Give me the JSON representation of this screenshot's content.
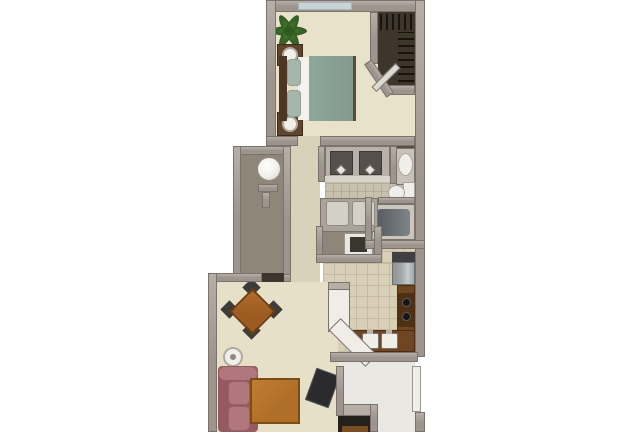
{
  "scene": {
    "kind": "3d-rendered apartment floor plan, top-down view, no visible text",
    "orientation": "tall narrow unit, bedroom at top, living room at bottom, plan cut off at bottom edge"
  },
  "palette": {
    "pageBg": "#ffffff",
    "wall": "#9c948d",
    "wallEdge": "#7a726b",
    "wallLight": "#b6afa8",
    "carpetBedroom": "#e9e2cb",
    "carpetHall": "#d8d2ba",
    "carpetLiving": "#e7e0c8",
    "tileBath": "#c7c1ad",
    "tileBathLine": "#b2ac98",
    "tileKitchen": "#d8cfb8",
    "tileKitchenLine": "#c4bba3",
    "closetDark": "#3f362b",
    "utilityFloor": "#8d8679",
    "entryFloor": "#e9e8e3",
    "window": "#c9d3d5",
    "bedComforter": "#8ea69b",
    "bedPillow": "#a5b7ac",
    "bedSheet": "#f3f2ed",
    "headboard": "#4e3625",
    "nightstand": "#5f442e",
    "lamp": "#f1efe9",
    "lampRing": "#b0aba2",
    "plant": "#2f5b21",
    "plantLight": "#4d7c33",
    "sofa": "#b0777c",
    "sofaDark": "#955a60",
    "diningTable": "#9d5b21",
    "diningTableEdge": "#6f3d10",
    "chair": "#3e3c39",
    "coffeeTable": "#b06f28",
    "coffeeTableEdge": "#7d4c15",
    "tv": "#2b2b2d",
    "tvEdge": "#54545a",
    "fridge": "#a2a7a7",
    "fridgeTop": "#404042",
    "counterBrown": "#6f4522",
    "stovePanel": "#4f3014",
    "burner": "#161616",
    "counterWhite": "#efede6",
    "fixtureWhite": "#efeee9",
    "fixtureEdge": "#a9a49c",
    "tubRim": "#c9c6be",
    "tubInner": "#575c60",
    "vanityCounter": "#b7b1a8",
    "basin": "#55504b",
    "washer": "#e9e7e1",
    "washerDark": "#38362f",
    "waterHeater": "#f0efe9",
    "shelfBrown": "#7a4e22",
    "hanger": "#17130f",
    "doorLeaf": "#dedbd4"
  },
  "rooms": [
    {
      "name": "bedroom",
      "floor": "cream carpet",
      "items": [
        "queen-bed-teal-comforter",
        "nightstand-upper",
        "nightstand-lower",
        "lamp-upper",
        "lamp-lower",
        "potted-plant",
        "window-top-wall"
      ]
    },
    {
      "name": "walk-in-closet",
      "floor": "dark brown",
      "items": [
        "hanging-clothes-top-row",
        "hanging-clothes-right-row",
        "angled-closet-door"
      ]
    },
    {
      "name": "bathroom",
      "floor": "small beige tile",
      "items": [
        "double-sink-vanity",
        "pedestal-sink",
        "toilet",
        "bathtub",
        "storage-cabinet",
        "washer-closet"
      ]
    },
    {
      "name": "utility-closet",
      "floor": "gray",
      "items": [
        "water-heater",
        "partition-stub"
      ]
    },
    {
      "name": "kitchen",
      "floor": "large beige tile",
      "items": [
        "refrigerator",
        "stove-two-burners",
        "double-basin-sink",
        "white-breakfast-bar-angled"
      ]
    },
    {
      "name": "living-dining-room",
      "floor": "cream carpet",
      "items": [
        "dining-table-diamond",
        "dining-chairs-x4",
        "floor-lamp",
        "rose-sofa",
        "coffee-table",
        "tv-angled"
      ]
    },
    {
      "name": "entry",
      "floor": "light vinyl",
      "items": [
        "front-door-open",
        "entry-ledge",
        "entry-closet-dark",
        "closet-shelf"
      ]
    }
  ]
}
